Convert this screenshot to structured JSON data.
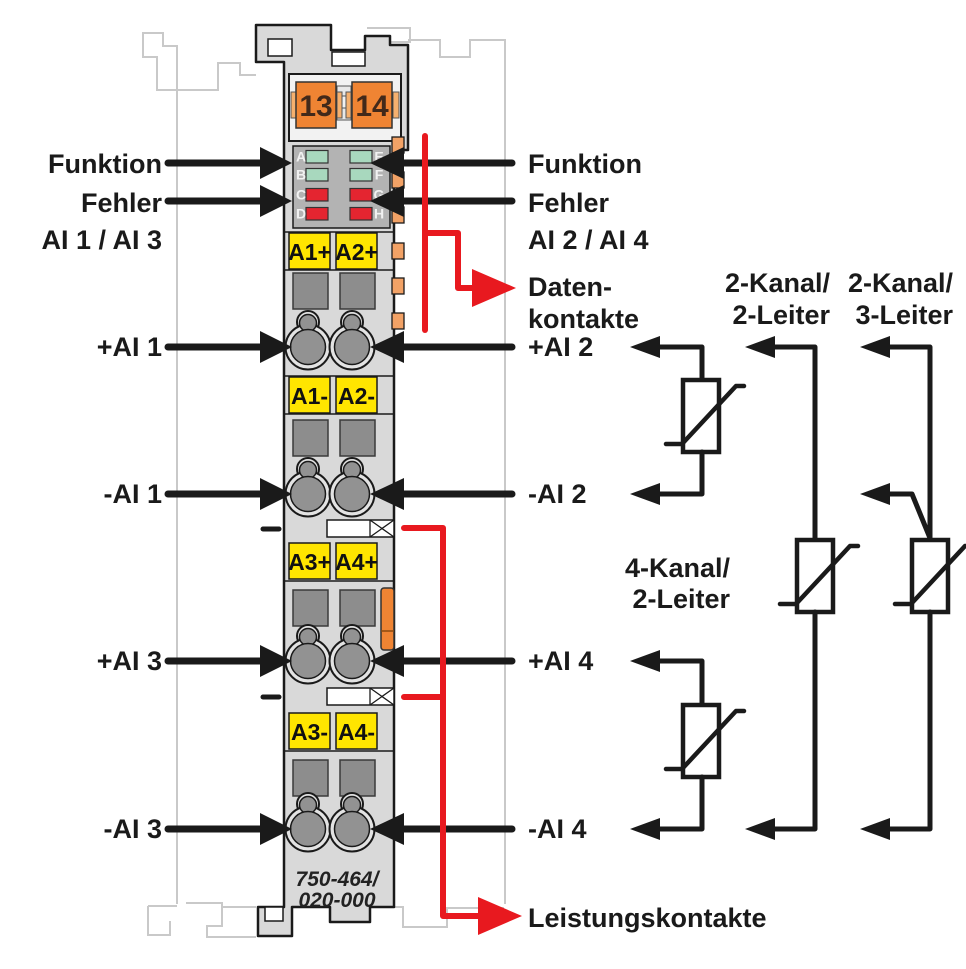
{
  "diagram": {
    "device": {
      "part_number_line1": "750-464/",
      "part_number_line2": "020-000",
      "connectors": [
        "13",
        "14"
      ],
      "led_letters": [
        "A",
        "B",
        "C",
        "D",
        "E",
        "F",
        "G",
        "H"
      ],
      "terminal_labels": [
        "A1+",
        "A2+",
        "A1-",
        "A2-",
        "A3+",
        "A4+",
        "A3-",
        "A4-"
      ]
    },
    "left_labels": {
      "funktion": "Funktion",
      "fehler": "Fehler",
      "fehler_channels": "AI 1 / AI 3",
      "p_ai1": "+AI 1",
      "m_ai1": "-AI 1",
      "p_ai3": "+AI 3",
      "m_ai3": "-AI 3"
    },
    "right_labels": {
      "funktion": "Funktion",
      "fehler": "Fehler",
      "fehler_channels": "AI 2 / AI 4",
      "daten_line1": "Daten-",
      "daten_line2": "kontakte",
      "p_ai2": "+AI 2",
      "m_ai2": "-AI 2",
      "p_ai4": "+AI 4",
      "m_ai4": "-AI 4",
      "leistung": "Leistungskontakte"
    },
    "wiring_labels": {
      "k2_2_line1": "2-Kanal/",
      "k2_2_line2": "2-Leiter",
      "k2_3_line1": "2-Kanal/",
      "k2_3_line2": "3-Leiter",
      "k4_2_line1": "4-Kanal/",
      "k4_2_line2": "2-Leiter"
    },
    "colors": {
      "red": "#e8191f",
      "orange": "#ef8433",
      "orange_light": "#f5b06e",
      "yellow": "#ffe500",
      "green_led": "#a8d8be",
      "red_led": "#e42530",
      "body": "#d9d9d9",
      "panel": "#b3b3b3",
      "contact": "#8d8d8d",
      "outline": "#1a1a1a",
      "ghost": "#c9c9c9"
    }
  }
}
